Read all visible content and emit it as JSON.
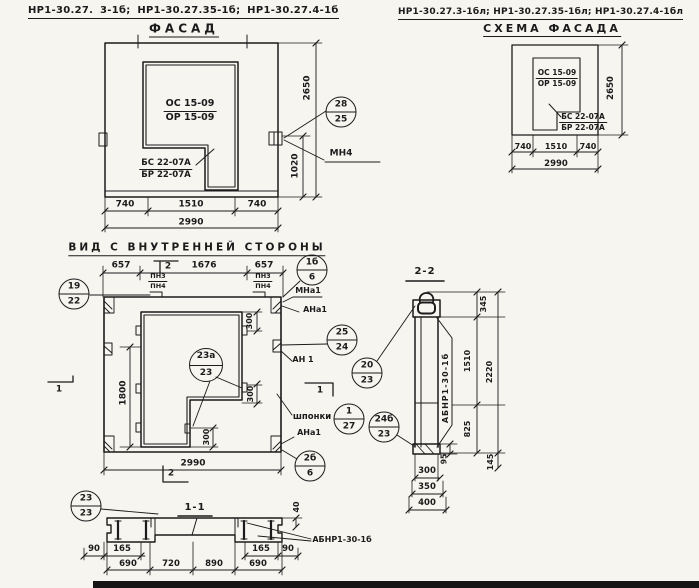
{
  "header_left": {
    "codes": "НР1-30.27. 3-1б; НР1-30.27.35-1б; НР1-30.27.4-1б",
    "view_title": "ФАСАД"
  },
  "header_right": {
    "codes": "НР1-30.27.3-1бл; НР1-30.27.35-1бл; НР1-30.27.4-1бл",
    "view_title": "СХЕМА ФАСАДА"
  },
  "facade": {
    "window_block": {
      "top": "ОС 15-09",
      "bottom": "ОР 15-09"
    },
    "sill_block": {
      "top": "БС 22-07А",
      "bottom": "БР 22-07А"
    },
    "dim_height_total": "2650",
    "dim_anchor_height": "1020",
    "dims_width": [
      "740",
      "1510",
      "740"
    ],
    "dim_width_total": "2990",
    "anchor_mark": "МН4",
    "callout_28_25": {
      "top": "28",
      "bottom": "25"
    }
  },
  "schema": {
    "window_block": {
      "top": "ОС 15-09",
      "bottom": "ОР 15-09"
    },
    "sill_block": {
      "top": "БС 22-07А",
      "bottom": "БР 22-07А"
    },
    "dim_height_total": "2650",
    "dims_width": [
      "740",
      "1510",
      "740"
    ],
    "dim_width_total": "2990"
  },
  "inner_view": {
    "title": "ВИД С ВНУТРЕННЕЙ СТОРОНЫ",
    "dims_top": [
      "657",
      "1676",
      "657"
    ],
    "plate_left": {
      "top": "ПН3",
      "bottom": "ПН4"
    },
    "plate_right": {
      "top": "ПН3",
      "bottom": "ПН4"
    },
    "dim_opening_height": "1800",
    "dim_key_1": "300",
    "dim_key_2": "300",
    "dim_key_3": "300",
    "dim_width_total": "2990",
    "keys_label": "шпонки",
    "label_mna1": "МНа1",
    "label_ana1_top": "АНа1",
    "label_an1": "АН 1",
    "label_ana1_bottom": "АНа1",
    "section_mark_1": "1",
    "section_mark_2": "2",
    "callout_19_22": {
      "top": "19",
      "bottom": "22"
    },
    "callout_1b_6": {
      "top": "1б",
      "bottom": "6"
    },
    "callout_25_24": {
      "top": "25",
      "bottom": "24"
    },
    "callout_23a_23": {
      "top": "23а",
      "bottom": "23"
    },
    "callout_1_27": {
      "top": "1",
      "bottom": "27"
    },
    "callout_2b_6": {
      "top": "2б",
      "bottom": "6"
    }
  },
  "section_2_2": {
    "title": "2-2",
    "member_label": "АБНР1-30-1б",
    "dim_345": "345",
    "dim_1510": "1510",
    "dim_2220": "2220",
    "dim_825": "825",
    "dim_95": "95",
    "dim_145": "145",
    "dims_bottom": [
      "300",
      "350",
      "400"
    ],
    "callout_20_23": {
      "top": "20",
      "bottom": "23"
    },
    "callout_24b_23": {
      "top": "24б",
      "bottom": "23"
    }
  },
  "section_1_1": {
    "title": "1-1",
    "member_label": "АБНР1-30-1б",
    "dim_40": "40",
    "dim_90_left": "90",
    "dim_165_left": "165",
    "dim_165_right": "165",
    "dim_90_right": "90",
    "dims_bottom": [
      "690",
      "720",
      "890",
      "690"
    ],
    "callout_23_23": {
      "top": "23",
      "bottom": "23"
    }
  }
}
